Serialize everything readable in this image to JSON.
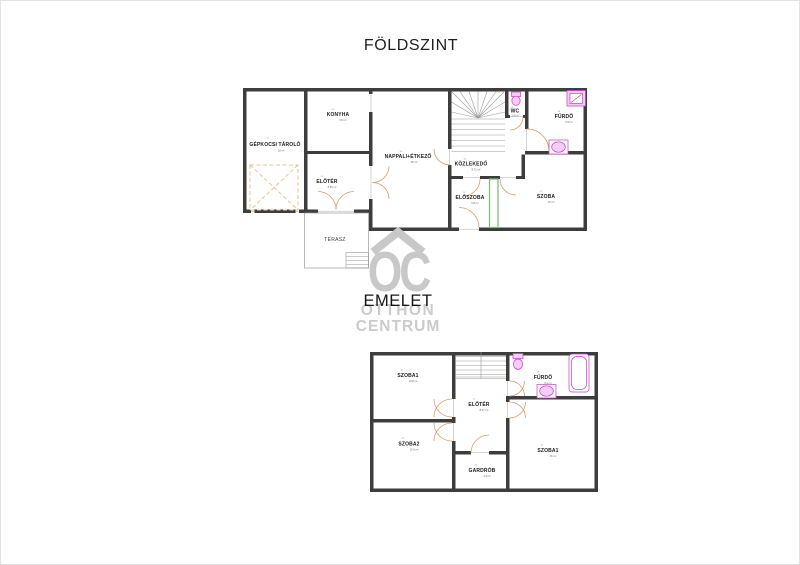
{
  "colors": {
    "wall": "#3d3d3d",
    "door_arc": "#d89c6a",
    "fixture": "#c73cc7",
    "fixture_fill": "#f3cdf3",
    "entrance_door_green": "#79b879",
    "watermark_gray": "#c8c8c8",
    "parking_dash": "#e6c496"
  },
  "ground_floor": {
    "title": "FÖLDSZINT",
    "rooms": [
      {
        "num": "01",
        "name": "GÉPKOCSI TÁROLÓ",
        "area": "18 m²"
      },
      {
        "num": "02",
        "name": "KONYHA",
        "area": "9.5 m²"
      },
      {
        "num": "03",
        "name": "ELŐTÉR",
        "area": "8.56 m²"
      },
      {
        "num": "04",
        "name": "NAPPALI+ÉTKEZŐ",
        "area": "30 m²"
      },
      {
        "num": "05",
        "name": "KÖZLEKEDŐ",
        "area": "8.71 m²"
      },
      {
        "num": "06",
        "name": "ELŐSZOBA",
        "area": "5.8 m²"
      },
      {
        "num": "07",
        "name": "SZOBA",
        "area": "15 m²"
      },
      {
        "num": "08",
        "name": "FÜRDŐ",
        "area": "5.9 m²"
      },
      {
        "num": "09",
        "name": "WC",
        "area": "1.5 m²"
      },
      {
        "num": "",
        "name": "TERASZ",
        "area": ""
      }
    ]
  },
  "upper_floor": {
    "title": "EMELET",
    "rooms": [
      {
        "num": "01",
        "name": "SZOBA1",
        "area": "13.8 m²"
      },
      {
        "num": "02",
        "name": "SZOBA2",
        "area": "13.6 m²"
      },
      {
        "num": "03",
        "name": "ELŐTÉR",
        "area": "8.07 m²"
      },
      {
        "num": "04",
        "name": "GARDRÓB",
        "area": "4.4 m²"
      },
      {
        "num": "05",
        "name": "FÜRDŐ",
        "area": "6.4 m²"
      },
      {
        "num": "06",
        "name": "SZOBA1",
        "area": "16 m²"
      }
    ]
  },
  "watermark": {
    "logo": "OC",
    "line1": "OTTHON",
    "line2": "CENTRUM"
  }
}
